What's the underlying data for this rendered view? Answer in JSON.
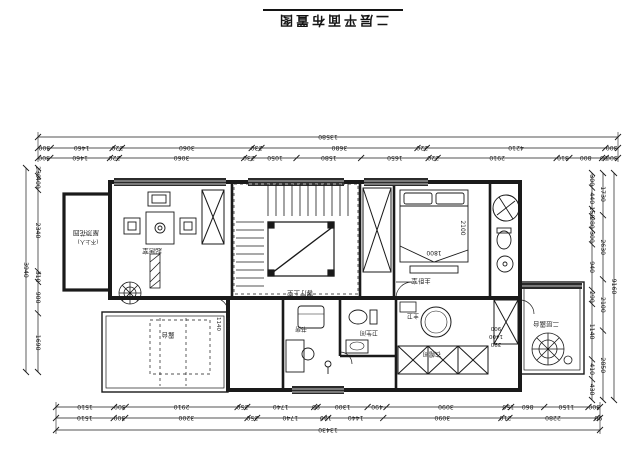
{
  "title": "二层平面布置图",
  "labels": [
    {
      "id": "roof-garden",
      "text": "屋顶花园",
      "x": 86,
      "y": 231,
      "rot": 180,
      "size": 6.5
    },
    {
      "id": "roof-garden-sub",
      "text": "(不上人)",
      "x": 88,
      "y": 240,
      "rot": 180,
      "size": 5.5
    },
    {
      "id": "family-room",
      "text": "起居室",
      "x": 152,
      "y": 249,
      "rot": 180,
      "size": 6.5
    },
    {
      "id": "stair-void",
      "text": "客厅上空",
      "x": 300,
      "y": 291,
      "rot": 180,
      "size": 6.5
    },
    {
      "id": "master-bedroom",
      "text": "主卧室",
      "x": 421,
      "y": 279,
      "rot": 180,
      "size": 6.5
    },
    {
      "id": "master-bath",
      "text": "主卫",
      "x": 413,
      "y": 314,
      "rot": 180,
      "size": 6
    },
    {
      "id": "toilet-room",
      "text": "卫生间",
      "x": 369,
      "y": 331,
      "rot": 180,
      "size": 6
    },
    {
      "id": "study",
      "text": "书房",
      "x": 301,
      "y": 327,
      "rot": 180,
      "size": 6
    },
    {
      "id": "closet",
      "text": "衣帽间",
      "x": 432,
      "y": 352,
      "rot": 180,
      "size": 6
    },
    {
      "id": "terrace-left",
      "text": "露台",
      "x": 168,
      "y": 333,
      "rot": 180,
      "size": 6.5
    },
    {
      "id": "terrace-right",
      "text": "二层露台",
      "x": 546,
      "y": 322,
      "rot": 180,
      "size": 6.5
    },
    {
      "id": "bed-width",
      "text": "1800",
      "x": 434,
      "y": 251,
      "rot": 180,
      "size": 6
    },
    {
      "id": "bed-length",
      "text": "2100",
      "x": 461,
      "y": 228,
      "rot": 90,
      "size": 6
    },
    {
      "id": "terrace-note-1",
      "text": "1140",
      "x": 217,
      "y": 324,
      "rot": 90,
      "size": 5.5
    },
    {
      "id": "terrace-note-2",
      "text": "1190",
      "x": 226,
      "y": 324,
      "rot": 90,
      "size": 5.5
    },
    {
      "id": "rail-note-1",
      "text": "900",
      "x": 496,
      "y": 327,
      "rot": 180,
      "size": 5.5
    },
    {
      "id": "rail-note-2",
      "text": "1400",
      "x": 496,
      "y": 335,
      "rot": 180,
      "size": 5.5
    },
    {
      "id": "rail-note-3",
      "text": "390",
      "x": 496,
      "y": 343,
      "rot": 180,
      "size": 5.5
    }
  ],
  "dimensions": {
    "top": {
      "total": [
        "13580"
      ],
      "row2": [
        "300",
        "1460",
        "220",
        "3060",
        "230",
        "3680",
        "220",
        "4210",
        "300"
      ],
      "row3": [
        "300",
        "1460",
        "220",
        "3060",
        "230",
        "1050",
        "1580",
        "1650",
        "220",
        "2910",
        "310",
        "800",
        "90",
        "300"
      ]
    },
    "bottom": {
      "row1": [
        "1510",
        "300",
        "2910",
        "250",
        "1740",
        "90",
        "1300",
        "490",
        "3090",
        "150",
        "860",
        "1150",
        "300"
      ],
      "row2": [
        "1510",
        "300",
        "3200",
        "250",
        "1740",
        "120",
        "1440",
        "3090",
        "210",
        "2280",
        "90"
      ],
      "total": [
        "13430"
      ]
    },
    "left": {
      "total": [
        "3940"
      ],
      "row": [
        "230",
        "400",
        "2340",
        "310",
        "900",
        "1690"
      ]
    },
    "right": {
      "row": [
        "300",
        "440",
        "150",
        "280",
        "300",
        "940",
        "290",
        "1140",
        "410",
        "430"
      ],
      "mid": [
        "1730",
        "2630",
        "2100",
        "2850"
      ],
      "total": [
        "9160"
      ]
    }
  },
  "line_color": "#1a1a1a"
}
